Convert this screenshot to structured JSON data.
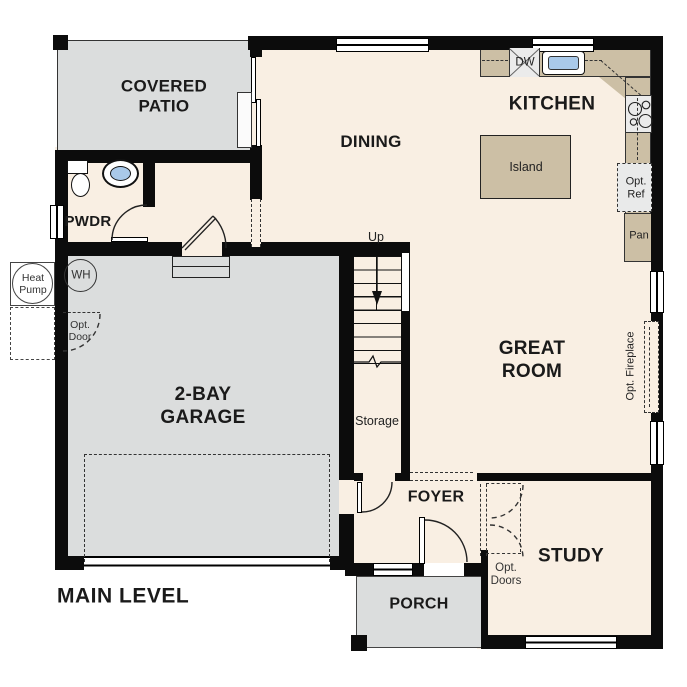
{
  "title": "MAIN LEVEL",
  "labels": {
    "title": "MAIN LEVEL",
    "patio": "COVERED\nPATIO",
    "pwdr": "PWDR",
    "dining": "DINING",
    "kitchen": "KITCHEN",
    "island": "Island",
    "great_room": "GREAT\nROOM",
    "garage": "2-BAY\nGARAGE",
    "foyer": "FOYER",
    "study": "STUDY",
    "porch": "PORCH",
    "storage": "Storage",
    "up": "Up",
    "dw": "DW",
    "opt_ref": "Opt.\nRef",
    "pan": "Pan",
    "opt_fireplace": "Opt. Fireplace",
    "opt_door": "Opt.\nDoor",
    "opt_doors": "Opt.\nDoors",
    "heat_pump": "Heat\nPump",
    "wh": "WH"
  },
  "colors": {
    "floor": "#f9efe3",
    "hard": "#dbdddd",
    "counter": "#ccbfa5",
    "wall": "#0c0c0c",
    "sink": "#a9c9e9",
    "appliance": "#ebebeb"
  }
}
